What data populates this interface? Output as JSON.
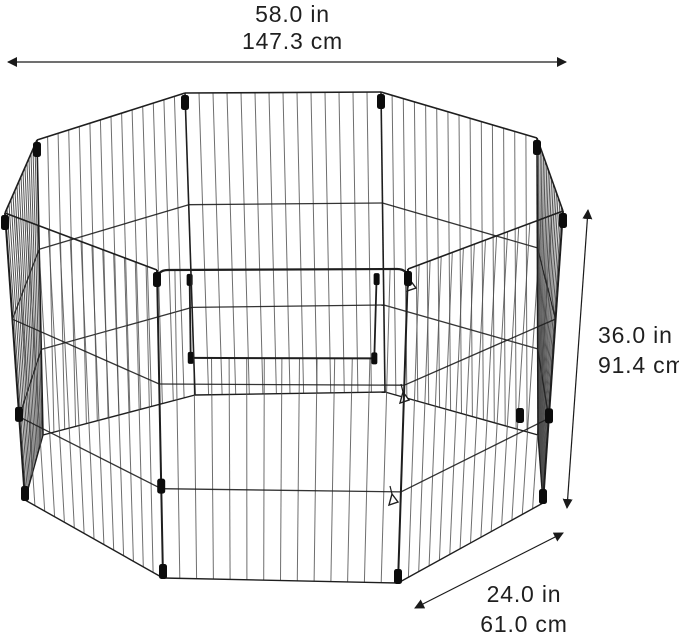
{
  "dimensions": {
    "width": {
      "inches": "58.0 in",
      "centimeters": "147.3 cm"
    },
    "height": {
      "inches": "36.0 in",
      "centimeters": "91.4 cm"
    },
    "depth": {
      "inches": "24.0 in",
      "centimeters": "61.0 cm"
    }
  },
  "colors": {
    "background": "#ffffff",
    "wire": "#4a4a4a",
    "frame": "#1e1e1e",
    "connector": "#0c0c0c",
    "dimension_line": "#1a1a1a",
    "label_text": "#1f1f1f"
  }
}
